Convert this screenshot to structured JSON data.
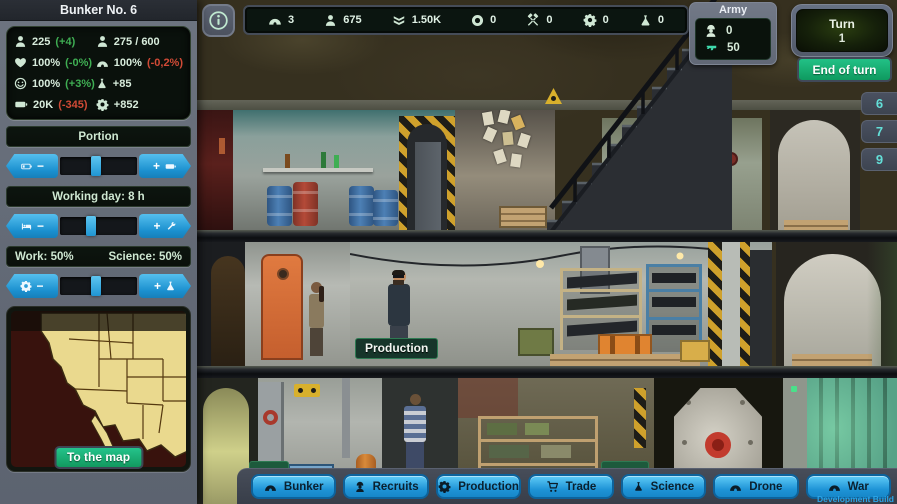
{
  "colors": {
    "accent_blue": "#29a3e0",
    "accent_green": "#17b377",
    "panel_dark_green": "#0a120c",
    "mint_text": "#d8ecdc",
    "delta_green": "#3fae53",
    "delta_red": "#d14a36",
    "tab_cyan": "#63dfd8",
    "sidebar_slate": "#636a76",
    "map_land": "#ead98e",
    "map_bg": "#38120d"
  },
  "sidebar": {
    "title": "Bunker No. 6",
    "stats": [
      {
        "icon": "person-icon",
        "value": "225",
        "delta": "(+4)",
        "delta_color": "green"
      },
      {
        "icon": "person-icon",
        "value": "275 / 600",
        "delta": "",
        "delta_color": "none"
      },
      {
        "icon": "heart-icon",
        "value": "100%",
        "delta": "(-0%)",
        "delta_color": "green"
      },
      {
        "icon": "bunker-icon",
        "value": "100%",
        "delta": "(-0,2%)",
        "delta_color": "red"
      },
      {
        "icon": "smiley-icon",
        "value": "100%",
        "delta": "(+3%)",
        "delta_color": "green"
      },
      {
        "icon": "flask-icon",
        "value": "+85",
        "delta": "",
        "delta_color": "none"
      },
      {
        "icon": "battery-icon",
        "value": "20K",
        "delta": "(-345)",
        "delta_color": "red"
      },
      {
        "icon": "gear-icon",
        "value": "+852",
        "delta": "",
        "delta_color": "none"
      }
    ],
    "portion": {
      "label": "Portion",
      "minus": "−",
      "plus": "+",
      "value_percent": 47
    },
    "working_day": {
      "label": "Working day: 8 h",
      "minus": "−",
      "plus": "+",
      "value_percent": 40
    },
    "work_science": {
      "work_label": "Work: 50%",
      "science_label": "Science: 50%",
      "minus": "−",
      "plus": "+",
      "value_percent": 47
    },
    "map_button": "To the map"
  },
  "top_bar": {
    "resources": [
      {
        "icon": "bunker-icon",
        "value": "3"
      },
      {
        "icon": "person-icon",
        "value": "675"
      },
      {
        "icon": "rank-icon",
        "value": "1.50K"
      },
      {
        "icon": "bottlecap-icon",
        "value": "0"
      },
      {
        "icon": "tools-icon",
        "value": "0"
      },
      {
        "icon": "gear-icon",
        "value": "0"
      },
      {
        "icon": "flask-icon",
        "value": "0"
      }
    ]
  },
  "army": {
    "title": "Army",
    "soldiers": "0",
    "weapons": "50"
  },
  "turn": {
    "label": "Turn",
    "number": "1",
    "end_button": "End of turn"
  },
  "floor_tabs": [
    {
      "label": "6"
    },
    {
      "label": "7"
    },
    {
      "label": "9"
    }
  ],
  "scene": {
    "room_label": "Production"
  },
  "bottom_nav": {
    "items": [
      {
        "icon": "bunker-icon",
        "label": "Bunker"
      },
      {
        "icon": "recruit-icon",
        "label": "Recruits"
      },
      {
        "icon": "gear-icon",
        "label": "Production"
      },
      {
        "icon": "cart-icon",
        "label": "Trade"
      },
      {
        "icon": "flask-icon",
        "label": "Science"
      },
      {
        "icon": "bunker-icon",
        "label": "Drone"
      },
      {
        "icon": "bunker-icon",
        "label": "War"
      }
    ]
  },
  "watermark": "Development Build"
}
